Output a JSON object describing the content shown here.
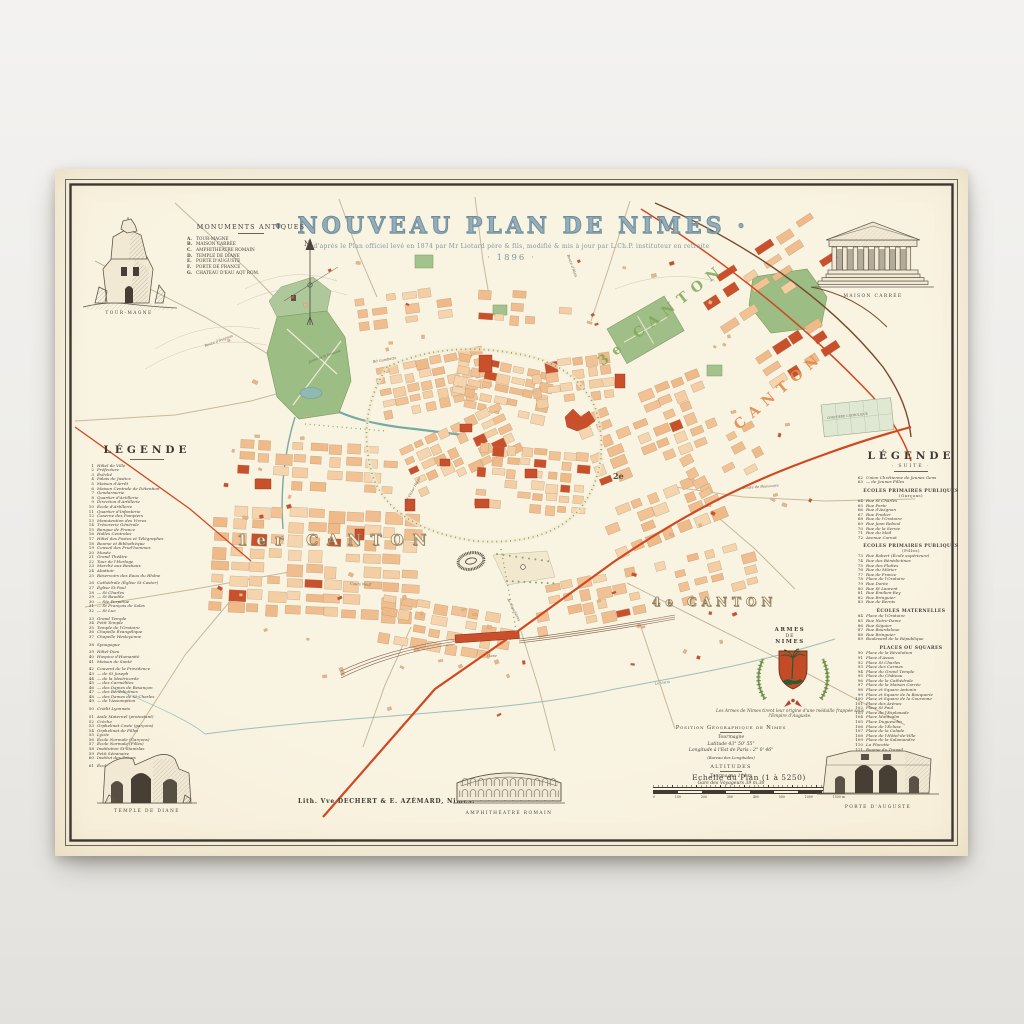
{
  "poster": {
    "title": "· NOUVEAU PLAN DE NIMES ·",
    "subtitle": "d'après le Plan officiel levé en 1874 par Mr Liotard père & fils, modifié & mis à jour par L.Ch.P. instituteur en retraite",
    "year": "· 1896 ·"
  },
  "palette": {
    "paper": "#f6efdc",
    "ink": "#3c3831",
    "title_blue": "#7d98a8",
    "block_peach": "#f3c79b",
    "landmark_red": "#c9502a",
    "park_green": "#9cbd84",
    "water_teal": "#76aaa2",
    "rail_red": "#cf4a22",
    "rail_brown": "#7a4a30"
  },
  "monuments_antiques": {
    "heading": "MONUMENTS ANTIQUES",
    "items": [
      {
        "k": "A.",
        "t": "TOUR-MAGNE"
      },
      {
        "k": "B.",
        "t": "MAISON CARRÉE"
      },
      {
        "k": "C.",
        "t": "AMPHITHÉATRE ROMAIN"
      },
      {
        "k": "D.",
        "t": "TEMPLE DE DIANE"
      },
      {
        "k": "E.",
        "t": "PORTE D'AUGUSTE"
      },
      {
        "k": "F.",
        "t": "PORTE DE FRANCE"
      },
      {
        "k": "G.",
        "t": "CHATEAU D'EAU AQT ROM."
      }
    ]
  },
  "legend_left": {
    "heading": "LÉGENDE",
    "items": [
      {
        "n": "1",
        "t": "Hôtel de Ville"
      },
      {
        "n": "2",
        "t": "Préfecture"
      },
      {
        "n": "3",
        "t": "Évêché"
      },
      {
        "n": "4",
        "t": "Palais de Justice"
      },
      {
        "n": "5",
        "t": "Maison d'Arrêt"
      },
      {
        "n": "6",
        "t": "Maison Centrale de Détention"
      },
      {
        "n": "7",
        "t": "Gendarmerie"
      },
      {
        "n": "8",
        "t": "Quartier d'Artillerie"
      },
      {
        "n": "9",
        "t": "Direction d'Artillerie"
      },
      {
        "n": "10",
        "t": "École d'Artillerie"
      },
      {
        "n": "11",
        "t": "Quartier d'Infanterie"
      },
      {
        "n": "12",
        "t": "Caserne des Pompiers"
      },
      {
        "n": "13",
        "t": "Manutention des Vivres"
      },
      {
        "n": "14",
        "t": "Trésorerie Générale"
      },
      {
        "n": "15",
        "t": "Banque de France"
      },
      {
        "n": "16",
        "t": "Halles Centrales"
      },
      {
        "n": "17",
        "t": "Hôtel des Postes et Télégraphes"
      },
      {
        "n": "18",
        "t": "Bourse et Bibliothèque"
      },
      {
        "n": "19",
        "t": "Conseil des Prud'hommes"
      },
      {
        "n": "20",
        "t": "Musée"
      },
      {
        "n": "21",
        "t": "Grand Théâtre"
      },
      {
        "n": "22",
        "t": "Tour de l'Horloge"
      },
      {
        "n": "23",
        "t": "Marché aux Bestiaux"
      },
      {
        "n": "24",
        "t": "Abattoir"
      },
      {
        "n": "25",
        "t": "Réservoirs des Eaux du Rhône"
      },
      {
        "n": "26",
        "t": "Cathédrale (Église St Castor)",
        "g": 1
      },
      {
        "n": "27",
        "t": "Église St Paul"
      },
      {
        "n": "28",
        "t": "—  St Charles"
      },
      {
        "n": "29",
        "t": "—  St Baudile"
      },
      {
        "n": "30",
        "t": "—  Ste Perpétue"
      },
      {
        "n": "31",
        "t": "—  St François de Sales"
      },
      {
        "n": "32",
        "t": "—  St Luc"
      },
      {
        "n": "33",
        "t": "Grand Temple",
        "g": 1
      },
      {
        "n": "34",
        "t": "Petit Temple"
      },
      {
        "n": "35",
        "t": "Temple de l'Oratoire"
      },
      {
        "n": "36",
        "t": "Chapelle Évangélique"
      },
      {
        "n": "37",
        "t": "Chapelle Wesleyenne"
      },
      {
        "n": "38",
        "t": "Synagogue",
        "g": 1
      },
      {
        "n": "39",
        "t": "Hôtel-Dieu",
        "g": 1
      },
      {
        "n": "40",
        "t": "Hospice d'Humanité"
      },
      {
        "n": "41",
        "t": "Maison de Santé"
      },
      {
        "n": "42",
        "t": "Couvent de la Providence",
        "g": 1
      },
      {
        "n": "43",
        "t": "—  de St Joseph"
      },
      {
        "n": "44",
        "t": "—  de la Miséricorde"
      },
      {
        "n": "45",
        "t": "—  des Carmélites"
      },
      {
        "n": "46",
        "t": "—  des Dames de Besançon"
      },
      {
        "n": "47",
        "t": "—  des Bénédictines"
      },
      {
        "n": "48",
        "t": "—  des Dames de St-Charles"
      },
      {
        "n": "49",
        "t": "—  de l'Assomption"
      },
      {
        "n": "50",
        "t": "Crédit Lyonnais",
        "g": 1
      },
      {
        "n": "51",
        "t": "Asile Maternel (protestant)",
        "g": 1
      },
      {
        "n": "52",
        "t": "Crèche"
      },
      {
        "n": "53",
        "t": "Orphelinat Coste (garçons)"
      },
      {
        "n": "54",
        "t": "Orphelinat de Filles"
      },
      {
        "n": "55",
        "t": "Lycée"
      },
      {
        "n": "56",
        "t": "École Normale (Garçons)"
      },
      {
        "n": "57",
        "t": "École Normale (Filles)"
      },
      {
        "n": "58",
        "t": "Institution St Stanislas"
      },
      {
        "n": "59",
        "t": "Petit Séminaire"
      },
      {
        "n": "60",
        "t": "Institut des Frères"
      },
      {
        "n": "61",
        "t": "École Professionnelle",
        "g": 1
      }
    ]
  },
  "legend_right": {
    "heading": "LÉGENDE",
    "subheading": "· SUITE ·",
    "intro": [
      {
        "n": "62",
        "t": "Union Chrétienne de Jeunes Gens"
      },
      {
        "n": "63",
        "t": "—  de Jeunes Filles"
      }
    ],
    "sections": [
      {
        "heading": "ÉCOLES PRIMAIRES PUBLIQUES",
        "sub": "(Garçons)",
        "items": [
          {
            "n": "64",
            "t": "Rue St Charles"
          },
          {
            "n": "65",
            "t": "Rue Porte"
          },
          {
            "n": "66",
            "t": "Rue d'Avignon"
          },
          {
            "n": "67",
            "t": "Rue Pradier"
          },
          {
            "n": "68",
            "t": "Rue de l'Oratoire"
          },
          {
            "n": "69",
            "t": "Rue Jean Reboul"
          },
          {
            "n": "70",
            "t": "Rue de la Servie"
          },
          {
            "n": "71",
            "t": "Rue du Mail"
          },
          {
            "n": "72",
            "t": "Avenue Carnot"
          }
        ]
      },
      {
        "heading": "ÉCOLES PRIMAIRES PUBLIQUES",
        "sub": "(Filles)",
        "items": [
          {
            "n": "73",
            "t": "Rue Robert (École supérieure)"
          },
          {
            "n": "74",
            "t": "Rue des Bénédictines"
          },
          {
            "n": "75",
            "t": "Rue des Flottes"
          },
          {
            "n": "76",
            "t": "Rue du Mûrier"
          },
          {
            "n": "77",
            "t": "Rue de France"
          },
          {
            "n": "78",
            "t": "Place de l'Oratoire"
          },
          {
            "n": "79",
            "t": "Rue Dorée"
          },
          {
            "n": "80",
            "t": "Rue St Laurent"
          },
          {
            "n": "81",
            "t": "Rue Émilien-Rey"
          },
          {
            "n": "82",
            "t": "Rue Bringuier"
          },
          {
            "n": "83",
            "t": "Rue de Bernis"
          }
        ]
      },
      {
        "heading": "ÉCOLES MATERNELLES",
        "sub": "",
        "items": [
          {
            "n": "84",
            "t": "Place de l'Oratoire"
          },
          {
            "n": "85",
            "t": "Rue Notre-Dame"
          },
          {
            "n": "86",
            "t": "Rue Séguier"
          },
          {
            "n": "87",
            "t": "Rue Bourdaloue"
          },
          {
            "n": "88",
            "t": "Rue Bringuier"
          },
          {
            "n": "89",
            "t": "Boulevard de la République"
          }
        ]
      },
      {
        "heading": "PLACES OU SQUARES",
        "sub": "",
        "items": [
          {
            "n": "90",
            "t": "Place de la Révolution"
          },
          {
            "n": "91",
            "t": "Place d'Assas"
          },
          {
            "n": "92",
            "t": "Place St Charles"
          },
          {
            "n": "93",
            "t": "Place des Carmes"
          },
          {
            "n": "94",
            "t": "Place du Grand Temple"
          },
          {
            "n": "95",
            "t": "Place du Château"
          },
          {
            "n": "96",
            "t": "Place de la Cathédrale"
          },
          {
            "n": "97",
            "t": "Place de la Maison Carrée"
          },
          {
            "n": "98",
            "t": "Place et Square Antonin"
          },
          {
            "n": "99",
            "t": "Place et Square de la Bouquerie"
          },
          {
            "n": "100",
            "t": "Place et Square de la Couronne"
          },
          {
            "n": "101",
            "t": "Place des Arènes"
          },
          {
            "n": "102",
            "t": "Place St Paul"
          },
          {
            "n": "103",
            "t": "Place de l'Esplanade"
          },
          {
            "n": "104",
            "t": "Place Montcalm"
          },
          {
            "n": "105",
            "t": "Place Duguesclin"
          },
          {
            "n": "106",
            "t": "Place de l'Écluse"
          },
          {
            "n": "107",
            "t": "Place de la Calade"
          },
          {
            "n": "108",
            "t": "Place de l'Hôtel-de-Ville"
          },
          {
            "n": "109",
            "t": "Place de la Salamandre"
          },
          {
            "n": "110",
            "t": "La Placette"
          },
          {
            "n": "111",
            "t": "Bourse du Travail"
          }
        ]
      }
    ]
  },
  "map_labels": {
    "compass_n": "N",
    "canton1": "1er CANTON",
    "canton2": "2e",
    "canton3": "3e CANTON",
    "canton3b": "CANTON",
    "canton4": "4e CANTON",
    "streets": [
      "Bd Gambetta",
      "Bd Victor Hugo",
      "Av. Feuchères",
      "Cours Neuf",
      "Route d'Avignon",
      "Route d'Alais",
      "Route de Beaucaire",
      "Gare",
      "Jardin de la Fontaine",
      "CIMETIÈRE CATHOLIQUE",
      "Le Vistre"
    ]
  },
  "armes": {
    "line1": "ARMES",
    "line2": "DE",
    "line3": "NIMES",
    "caption": "Les Armes de Nimes tirent leur origine d'une médaille frappée sous l'Empire d'Auguste."
  },
  "position": {
    "heading": "Position Géographique de Nimes",
    "sub": "Tourmagne",
    "latitude": "Latitude   43° 50' 55\"",
    "longitude": "Longitude à l'Est de Paris : 2° 0' 46\"",
    "note": "(Bureau des Longitudes)",
    "altitudes_heading": "ALTITUDES",
    "alt1": "Tourmagne  114 m",
    "alt2": "Gare des Voyageurs  39 m,30"
  },
  "scale": {
    "label": "Echelle du Plan (1 à 5250)",
    "ticks": [
      "0",
      "100",
      "200",
      "300",
      "400",
      "500",
      "1000",
      "1500 m"
    ]
  },
  "credit": "Lith. Vve DECHERT & E. AZÉMARD, Nimes.",
  "illustrations": {
    "tour_magne": "TOUR-MAGNE",
    "maison_carree": "MAISON CARRÉE",
    "temple_diane": "TEMPLE DE DIANE",
    "amphitheatre": "AMPHITHÉATRE ROMAIN",
    "porte_auguste": "PORTE D'AUGUSTE"
  }
}
